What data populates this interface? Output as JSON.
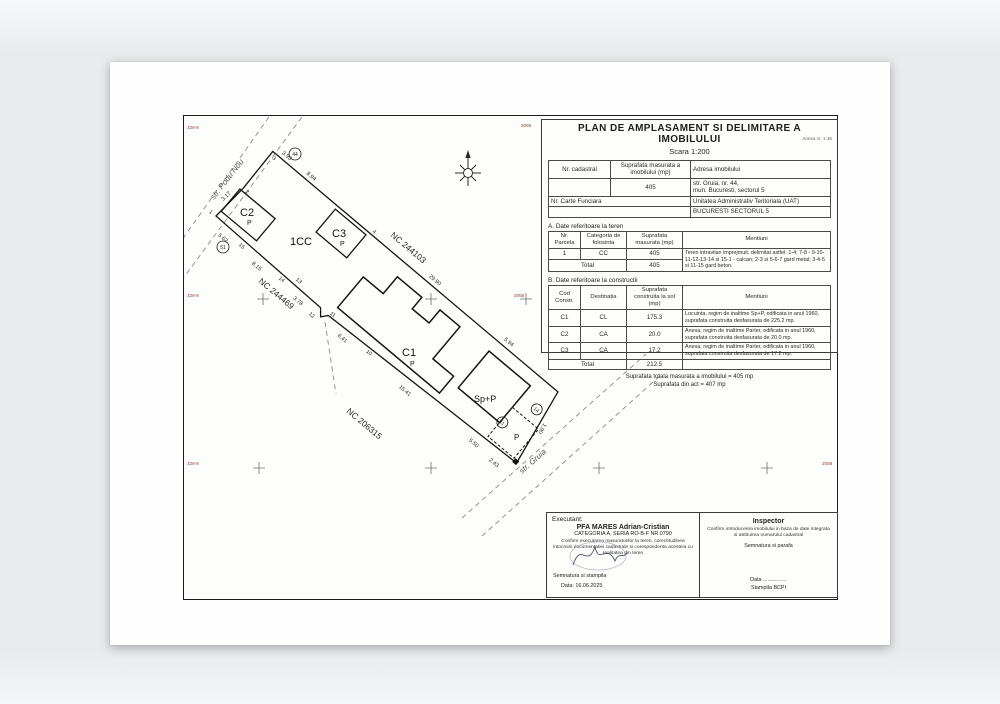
{
  "title_block": {
    "title": "PLAN DE AMPLASAMENT SI DELIMITARE A IMOBILULUI",
    "scale": "Scara 1:200",
    "annex_note": "Anexa nr. 1.35",
    "info_table": {
      "col_nr_cadastral": "Nr. cadastral",
      "col_suprafata": "Suprafata masurata a imobilului (mp)",
      "col_adresa": "Adresa imobilului",
      "suprafata_value": "405",
      "adresa_line1": "str. Gruia, nr. 44,",
      "adresa_line2": "mun. Bucuresti, sectorul 5",
      "carte_funciara_label": "Nr. Carte Funciara",
      "uat_label": "Unitatea Administrativ Teritoriala (UAT)",
      "uat_value": "BUCURESTI SECTORUL 5"
    }
  },
  "section_a": {
    "heading": "A. Date referitoare la teren",
    "headers": [
      "Nr. Parcela",
      "Categoria de folosinta",
      "Suprafata masurata (mp)",
      "Mentiuni"
    ],
    "row": {
      "nr": "1",
      "cat": "CC",
      "sup": "405",
      "mentiuni": "Teren intravilan imprejmuit, delimitat astfel: 1-4; 7-8 - 9-10-11-12-13-14 si 15-1 - calcan; 2-3 si 5-6-7 gard metal; 3-4-5 si 11-15 gard beton."
    },
    "total_label": "Total",
    "total_value": "405"
  },
  "section_b": {
    "heading": "B. Date referitoare la constructii",
    "headers": [
      "Cod Constr.",
      "Destinatia",
      "Suprafata construita la sol (mp)",
      "Mentiuni"
    ],
    "rows": [
      {
        "cod": "C1",
        "dest": "CL",
        "sup": "175.3",
        "mentiuni": "Locuinta, regim de inaltime Sp+P, edificata in anul 1960, suprafata construita desfasurata de 225.2 mp."
      },
      {
        "cod": "C2",
        "dest": "CA",
        "sup": "20.0",
        "mentiuni": "Anexa, regim de inaltime Parter, edificata in anul 1960, suprafata construita desfasurata de 20.0 mp."
      },
      {
        "cod": "C3",
        "dest": "CA",
        "sup": "17.2",
        "mentiuni": "Anexa, regim de inaltime Parter, edificata in anul 1960, suprafata construita desfasurata de 17.2 mp."
      }
    ],
    "total_label": "Total",
    "total_value": "212.5",
    "footer_line1": "Suprafata totala masurata a imobilului = 405 mp",
    "footer_line2": "Suprafata din act = 407 mp"
  },
  "executant": {
    "heading": "Executant:",
    "name": "PFA MARES Adrian-Cristian",
    "cert": "CATEGORIA A, SERIA RO-B-F NR.0790",
    "confirm": "Confirm executarea masuratorilor la teren, corectitudinea intocmirii documentatiei cadastrale si corespondenta acesteia cu realitatea din teren",
    "signature_label": "Semnatura si stampila",
    "date": "Data: 16.06.2025"
  },
  "inspector": {
    "heading": "Inspector",
    "confirm": "Confirm introducerea imobilului in baza de date integrata si atribuirea numarului cadastral",
    "signature_label": "Semnatura si parafa",
    "date_label": "Data ................",
    "stamp_label": "Stampila BCPI"
  },
  "plan": {
    "street_top": "str. Podu Nou",
    "street_bottom": "str. Gruia",
    "nc_top": "NC 244103",
    "nc_left": "NC 244469",
    "nc_bottom": "NC 206315",
    "parcel_label": "1CC",
    "c1": "C1",
    "c2": "C2",
    "c3": "C3",
    "p": "P",
    "sp_p": "Sp+P",
    "dims": {
      "d1": "3.93",
      "d2": "8.94",
      "d3": "29.90",
      "d4": "5.94",
      "d5": "3.17",
      "d6": "5.62",
      "d7": "8.15",
      "d8": "3.78",
      "d9": "6.41",
      "d10": "15.41",
      "d11": "5.50",
      "d12": "2.43",
      "d13": "1.90"
    },
    "points": {
      "p1": "1",
      "p2": "2",
      "p3": "3",
      "p4": "4",
      "p10": "10",
      "p11": "11",
      "p12": "12",
      "p13": "13",
      "p14": "14",
      "p15": "15",
      "c_a": "11",
      "c_b": "14",
      "c_c": "44",
      "c_d": "51"
    },
    "grid": {
      "left": "328-8",
      "right": "2058"
    }
  }
}
